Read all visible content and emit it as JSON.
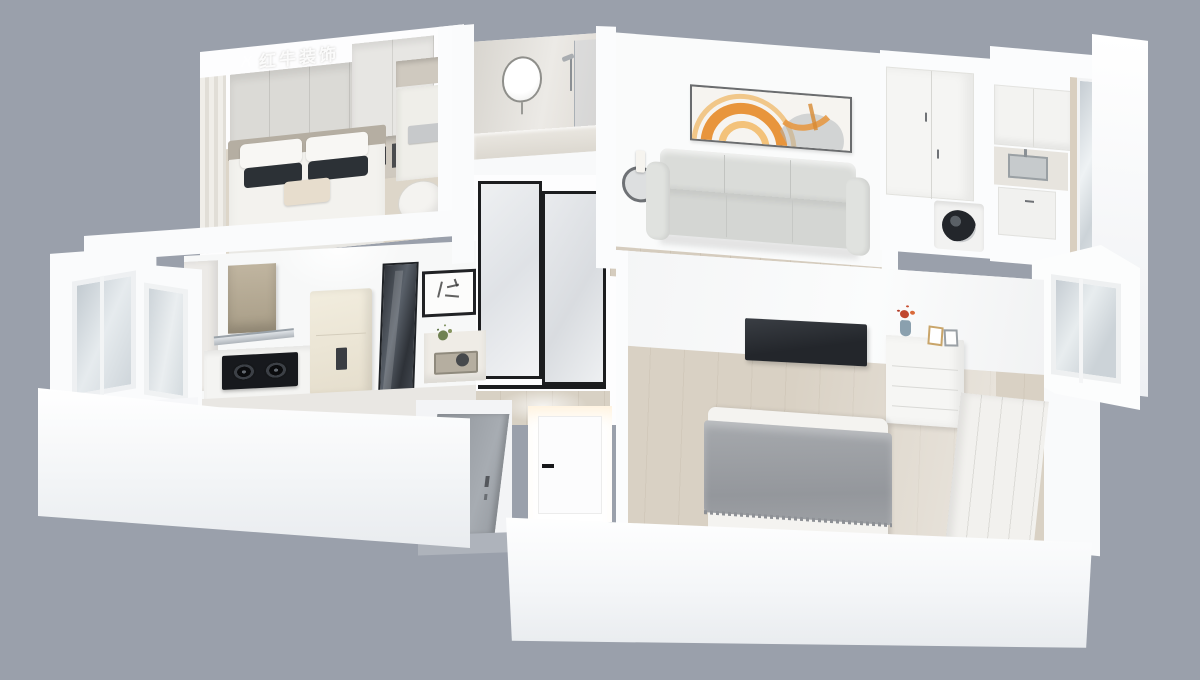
{
  "scene": {
    "description": "3D isometric dollhouse render of a small apartment floor plan on a plain gray backdrop",
    "background_color": "#9aa0ab",
    "watermark": {
      "text": "红牛装饰",
      "logo": "bull-logo",
      "color": "rgba(255,255,255,0.9)"
    }
  },
  "palette": {
    "backdrop": "#9aa0ab",
    "wall_white": "#fbfcfd",
    "wall_shade": "#e9ecef",
    "floor_wood": "#d9d1c4",
    "floor_wood_dark": "#d5ccbe",
    "floor_gray": "#aeb3bb",
    "sofa_gray": "#d8dad7",
    "pillow_dark": "#2c3136",
    "blanket_gray": "#9da0a4",
    "tv_black": "#2d3136",
    "art_orange": "#e8953c",
    "art_amber": "#f3c27a",
    "hood_tan": "#b3a893",
    "cooktop_black": "#17191d",
    "fridge_cream": "#ece7db",
    "glass_door_dark": "#41464c",
    "entry_door_gray": "#9ba0a6",
    "window_glass": "#ccd3d8",
    "flower_red": "#c0472f",
    "plant_green": "#6f8152",
    "chair_gold": "#b98d4f",
    "door_frame_black": "#1c1d1f"
  },
  "rooms": {
    "secondary_bedroom": {
      "items": [
        "wardrobe",
        "open-shelf-books",
        "bed",
        "white-pillows",
        "dark-pillows",
        "accent-pillow",
        "desk",
        "laptop",
        "desk-shelf",
        "chair",
        "curtain",
        "window"
      ]
    },
    "bathroom": {
      "items": [
        "round-mirror",
        "vanity-counter",
        "shower-set",
        "glass-screen"
      ]
    },
    "hallway": {
      "items": [
        "frosted-sliding-door",
        "wood-floor"
      ]
    },
    "living_room": {
      "items": [
        "three-seat-sofa",
        "abstract-wall-art",
        "round-side-table",
        "candle",
        "coffee-table",
        "small-plant",
        "wood-floor"
      ]
    },
    "laundry_nook": {
      "items": [
        "two-door-wardrobe",
        "washing-machine"
      ]
    },
    "utility_balcony": {
      "items": [
        "upper-cabinet",
        "sink-counter",
        "lower-cabinet",
        "window"
      ]
    },
    "master_bedroom": {
      "items": [
        "wall-tv",
        "dresser",
        "flower-vase",
        "photo-frames",
        "bed",
        "gray-throw-blanket",
        "sliding-wardrobe",
        "wood-floor",
        "bay-window"
      ]
    },
    "kitchen": {
      "items": [
        "range-hood",
        "gas-cooktop",
        "counter",
        "towel-bar",
        "refrigerator",
        "dark-glass-sliding-door",
        "calligraphy-art",
        "console-table",
        "tray",
        "plant",
        "tall-cabinet"
      ]
    },
    "balcony": {
      "items": [
        "bay-windows",
        "window-sill"
      ]
    },
    "entry": {
      "items": [
        "gray-entrance-door",
        "white-interior-door",
        "gray-floor"
      ]
    }
  }
}
